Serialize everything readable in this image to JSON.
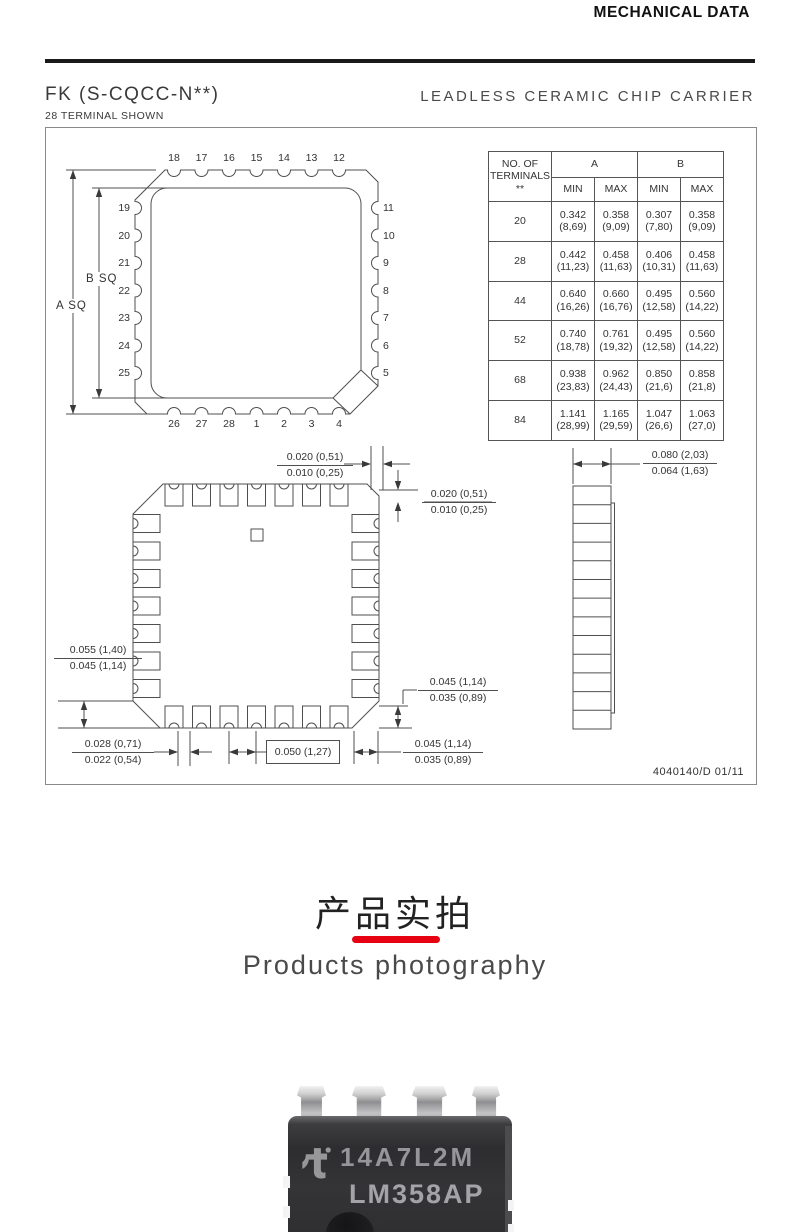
{
  "header": {
    "title": "MECHANICAL DATA"
  },
  "package": {
    "code": "FK (S-CQCC-N**)",
    "terminals_note": "28 TERMINAL SHOWN",
    "type": "LEADLESS CERAMIC CHIP CARRIER",
    "doc_number": "4040140/D 01/11"
  },
  "top_view": {
    "pins_top": [
      "18",
      "17",
      "16",
      "15",
      "14",
      "13",
      "12"
    ],
    "pins_left": [
      "19",
      "20",
      "21",
      "22",
      "23",
      "24",
      "25"
    ],
    "pins_right": [
      "11",
      "10",
      "9",
      "8",
      "7",
      "6",
      "5"
    ],
    "pins_bottom": [
      "26",
      "27",
      "28",
      "1",
      "2",
      "3",
      "4"
    ],
    "dim_outer": "A SQ",
    "dim_inner": "B SQ"
  },
  "table": {
    "header": {
      "col1_line1": "NO. OF",
      "col1_line2": "TERMINALS",
      "col1_line3": "**",
      "group_a": "A",
      "group_b": "B",
      "min": "MIN",
      "max": "MAX"
    },
    "rows": [
      {
        "n": "20",
        "a_min": [
          "0.342",
          "(8,69)"
        ],
        "a_max": [
          "0.358",
          "(9,09)"
        ],
        "b_min": [
          "0.307",
          "(7,80)"
        ],
        "b_max": [
          "0.358",
          "(9,09)"
        ]
      },
      {
        "n": "28",
        "a_min": [
          "0.442",
          "(11,23)"
        ],
        "a_max": [
          "0.458",
          "(11,63)"
        ],
        "b_min": [
          "0.406",
          "(10,31)"
        ],
        "b_max": [
          "0.458",
          "(11,63)"
        ]
      },
      {
        "n": "44",
        "a_min": [
          "0.640",
          "(16,26)"
        ],
        "a_max": [
          "0.660",
          "(16,76)"
        ],
        "b_min": [
          "0.495",
          "(12,58)"
        ],
        "b_max": [
          "0.560",
          "(14,22)"
        ]
      },
      {
        "n": "52",
        "a_min": [
          "0.740",
          "(18,78)"
        ],
        "a_max": [
          "0.761",
          "(19,32)"
        ],
        "b_min": [
          "0.495",
          "(12,58)"
        ],
        "b_max": [
          "0.560",
          "(14,22)"
        ]
      },
      {
        "n": "68",
        "a_min": [
          "0.938",
          "(23,83)"
        ],
        "a_max": [
          "0.962",
          "(24,43)"
        ],
        "b_min": [
          "0.850",
          "(21,6)"
        ],
        "b_max": [
          "0.858",
          "(21,8)"
        ]
      },
      {
        "n": "84",
        "a_min": [
          "1.141",
          "(28,99)"
        ],
        "a_max": [
          "1.165",
          "(29,59)"
        ],
        "b_min": [
          "1.047",
          "(26,6)"
        ],
        "b_max": [
          "1.063",
          "(27,0)"
        ]
      }
    ]
  },
  "dims": {
    "lead_width_top": {
      "over": "0.020 (0,51)",
      "under": "0.010 (0,25)"
    },
    "lead_width_side": {
      "over": "0.020 (0,51)",
      "under": "0.010 (0,25)"
    },
    "pad_length": {
      "over": "0.055 (1,40)",
      "under": "0.045 (1,14)"
    },
    "corner_clearance": {
      "over": "0.028 (0,71)",
      "under": "0.022 (0,54)"
    },
    "pitch": "0.050 (1,27)",
    "edge_clearance": {
      "over": "0.045 (1,14)",
      "under": "0.035 (0,89)"
    },
    "pad_width": {
      "over": "0.045 (1,14)",
      "under": "0.035 (0,89)"
    },
    "side_width": {
      "over": "0.080 (2,03)",
      "under": "0.064 (1,63)"
    }
  },
  "section": {
    "title_cn": "产品实拍",
    "title_en": "Products photography",
    "accent_color": "#e60012"
  },
  "photo": {
    "marking_line1": "14A7L2M",
    "marking_line2": "LM358AP"
  }
}
